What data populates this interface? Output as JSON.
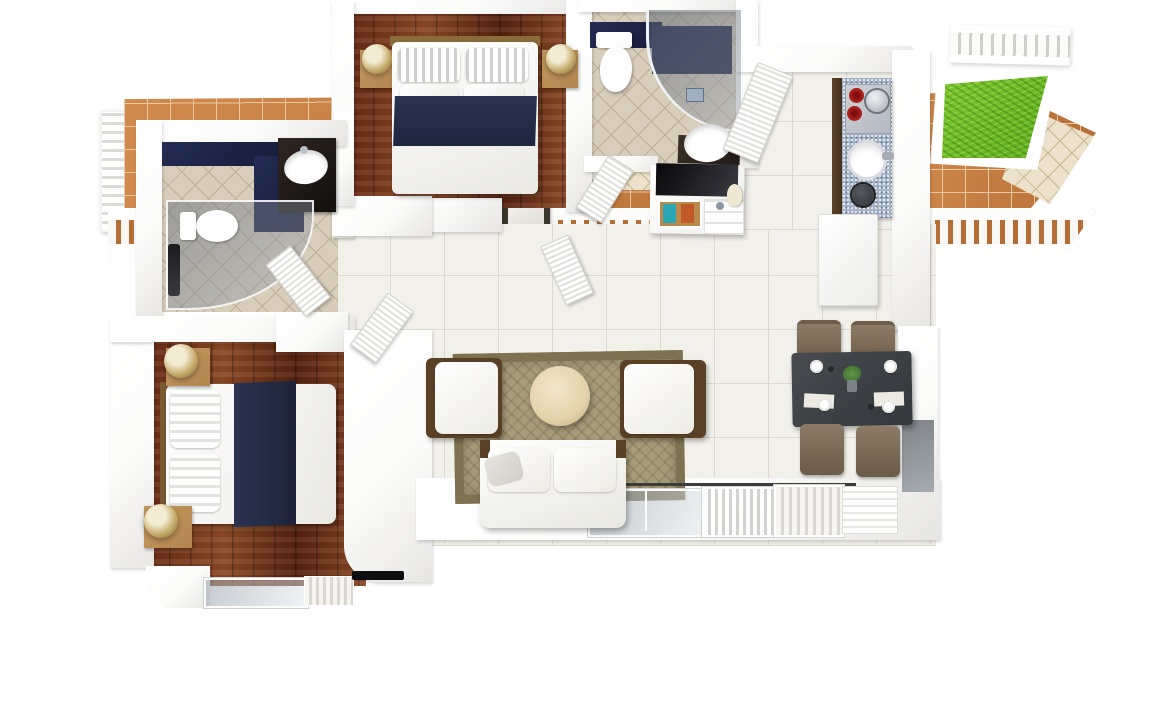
{
  "page": {
    "title": "3D Floor Plan — 2 Bedroom Apartment with Terrace"
  },
  "colors": {
    "wall": "#fbfbfa",
    "wallEdge": "#e7e6e3",
    "woodA": "#6b2d17",
    "woodB": "#8d4a27",
    "woodC": "#55220f",
    "tile": "#f2f0ea",
    "tileLine": "#ded9cf",
    "bathTile": "#d8cdbb",
    "bathLine": "#bcae96",
    "navy": "#252c55",
    "terraA": "#d08a4d",
    "terraB": "#b46d35",
    "terraLine": "#e9c9a4",
    "beige": "#ece1ca",
    "beigeLine": "#c8b68c",
    "grassA": "#7cc930",
    "grassB": "#5fae1e",
    "rug": "#a79c78",
    "rugBorder": "#7a704e",
    "cream": "#e3d3ac",
    "counter": "#a7b3c6",
    "cabinet": "#45301e",
    "burner": "#b2211d",
    "tableDark": "#3e4145",
    "chair": "#8c7b66",
    "chairDark": "#6e5d4a",
    "nstand": "#b2854e",
    "gold": "#c3a865",
    "lampLite": "#f2ecd2",
    "woodTrim": "#5a4126",
    "sage": "#a9c2a0",
    "frameDark": "#3a362b"
  },
  "rooms": [
    {
      "id": "bedroom-2",
      "label": "Bedroom 2",
      "floor": "hardwood",
      "furniture": [
        "double bed with navy runner",
        "nightstand with lamp",
        "nightstand with lamp"
      ]
    },
    {
      "id": "bathroom-2",
      "label": "Bathroom 2",
      "floor": "beige tile",
      "furniture": [
        "toilet",
        "curved glass shower",
        "washbasin",
        "door"
      ]
    },
    {
      "id": "entry",
      "label": "Entry",
      "floor": "white tile",
      "furniture": [
        "front door",
        "console cabinet with books and vase"
      ]
    },
    {
      "id": "kitchen",
      "label": "Kitchen",
      "floor": "white tile",
      "furniture": [
        "cooktop with red burners",
        "kettle",
        "round sink",
        "pot",
        "refrigerator",
        "dark base cabinets"
      ]
    },
    {
      "id": "master-bathroom",
      "label": "Master Bathroom",
      "floor": "beige tile",
      "furniture": [
        "toilet",
        "curved glass shower",
        "vanity with oval basin",
        "door"
      ]
    },
    {
      "id": "master-bedroom",
      "label": "Master Bedroom",
      "floor": "hardwood",
      "furniture": [
        "double bed with navy runner",
        "nightstand with lamp",
        "nightstand with lamp",
        "wall tv",
        "sliding glass door"
      ]
    },
    {
      "id": "living-room",
      "label": "Living Room",
      "floor": "white tile",
      "furniture": [
        "patterned rug",
        "round coffee table",
        "armchair",
        "armchair",
        "loveseat",
        "sliding glass doors"
      ]
    },
    {
      "id": "dining-area",
      "label": "Dining Area",
      "floor": "white tile",
      "furniture": [
        "dark dining table",
        "4 brown chairs",
        "4 place settings",
        "centerpiece plant"
      ]
    },
    {
      "id": "terrace",
      "label": "Terrace",
      "floor": "terracotta and beige pavers",
      "furniture": [
        "square outdoor table",
        "4 outdoor chairs",
        "lawn patch",
        "white balustrade railing"
      ]
    }
  ]
}
